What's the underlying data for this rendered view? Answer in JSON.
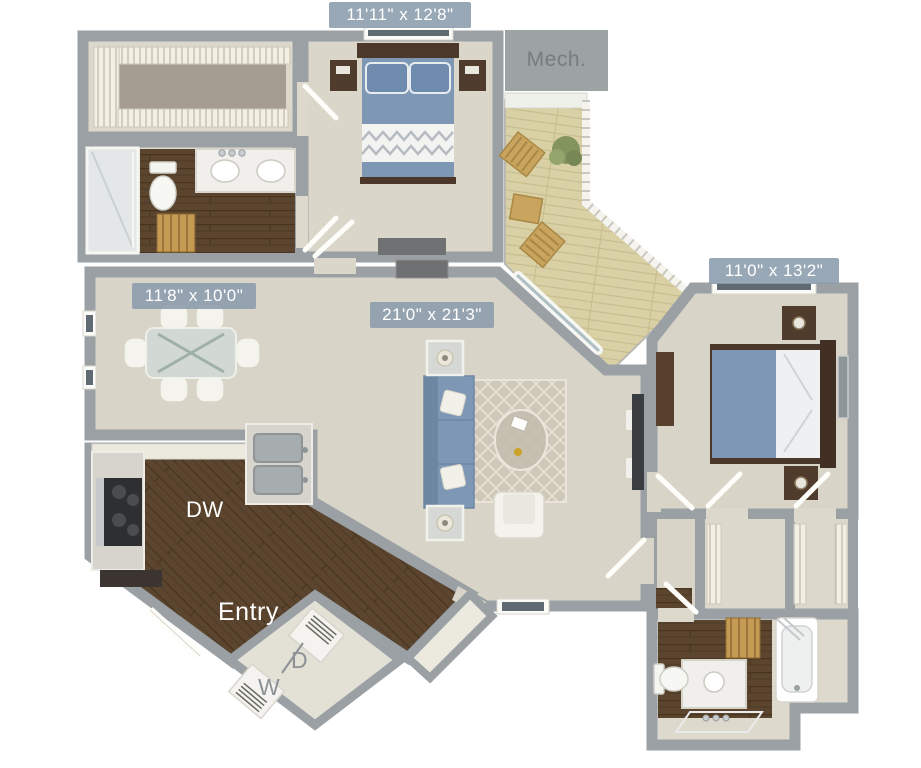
{
  "floor_plan": {
    "room_dimensions": {
      "bedroom1": "11'11\" x 12'8\"",
      "bedroom2": "11'0\" x 13'2\"",
      "dining": "11'8\" x 10'0\"",
      "living": "21'0\" x 21'3\""
    },
    "labels": {
      "mechanical_room": "Mech.",
      "dishwasher": "DW",
      "entry": "Entry",
      "washer": "W",
      "dryer": "D"
    },
    "colors": {
      "wall": "#9aa0a4",
      "carpet": "#d9d4c8",
      "dark_wood": "#5b452f",
      "deck_wood": "#d9d1a5",
      "bedding_blue": "#7e97b5",
      "dimension_badge": "#8b9cad"
    }
  }
}
